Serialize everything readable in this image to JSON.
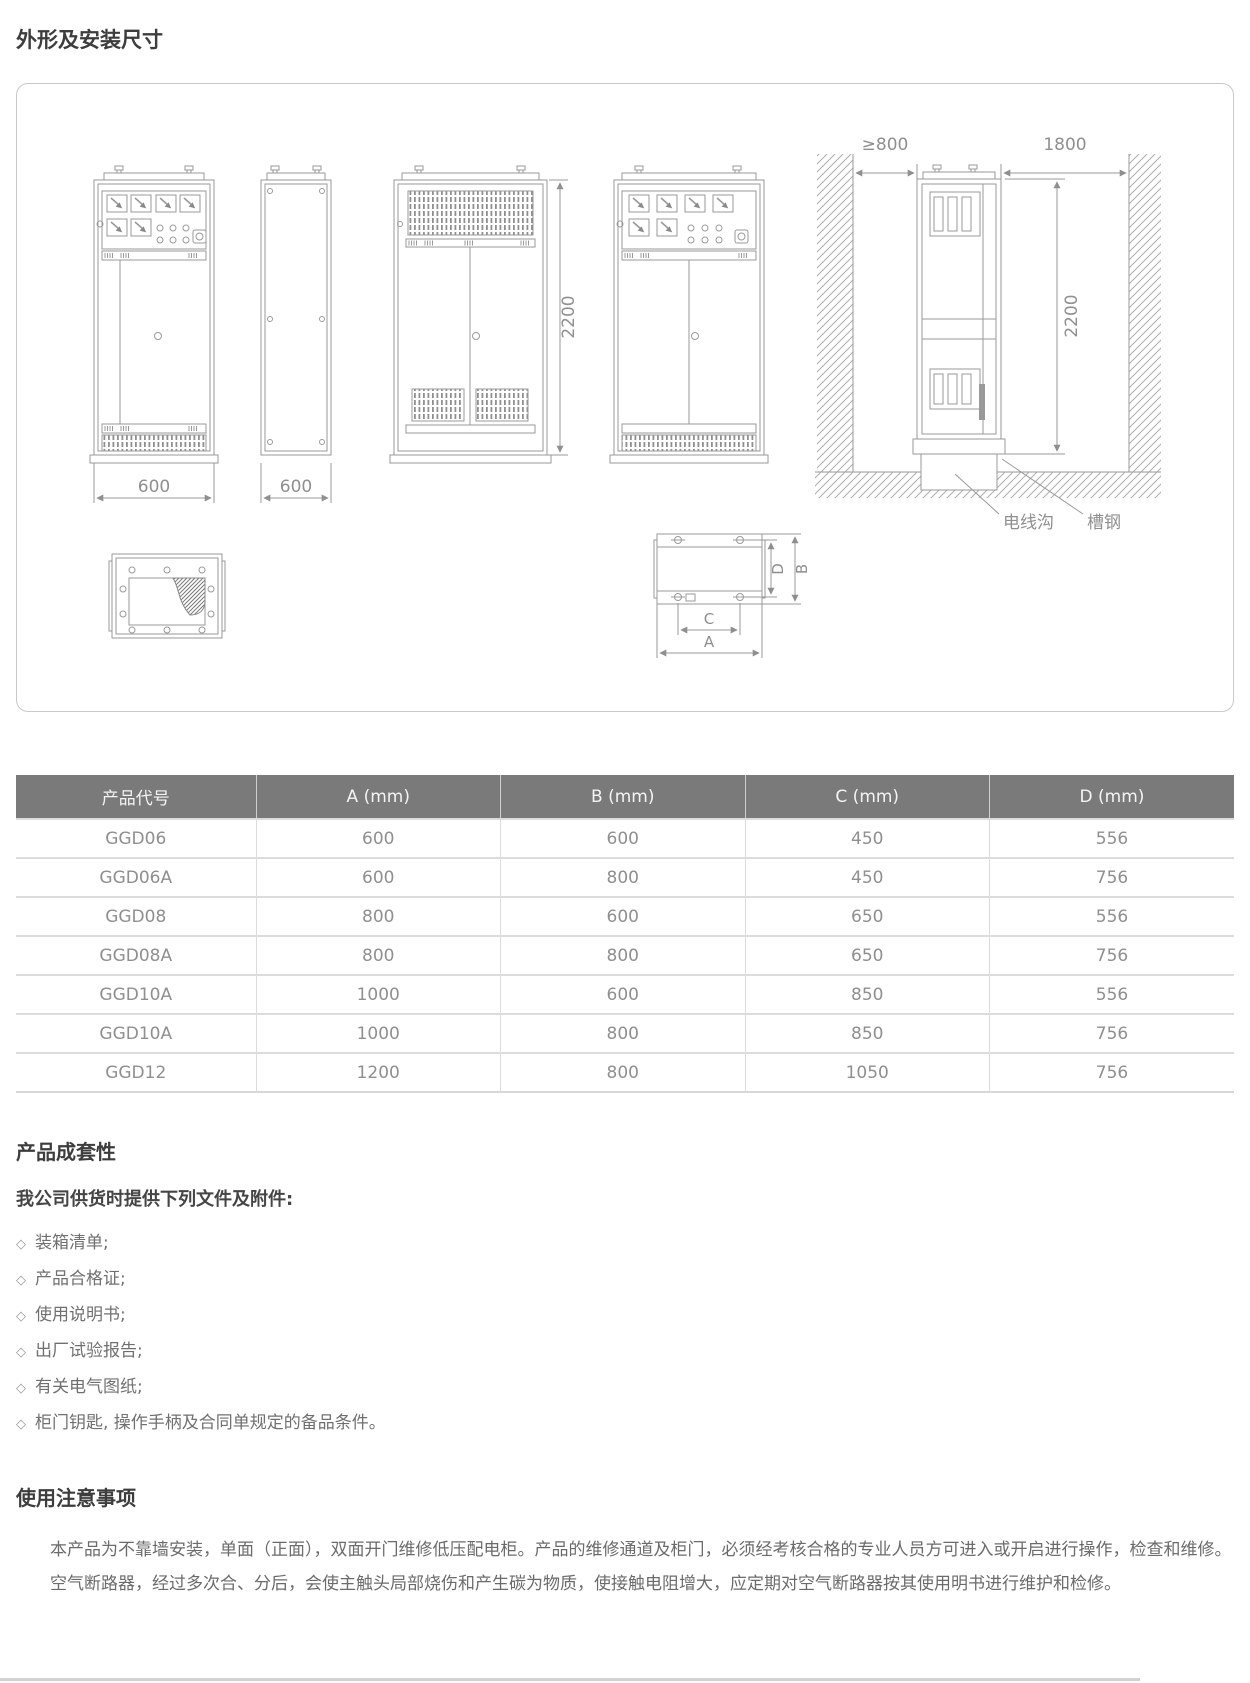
{
  "page": {
    "section1_title": "外形及安装尺寸",
    "section2_title": "产品成套性",
    "section2_subtitle": "我公司供货时提供下列文件及附件:",
    "section3_title": "使用注意事项"
  },
  "diagram": {
    "labels": {
      "front_width": "600",
      "side_depth": "600",
      "cabinet_height": "2200",
      "install_height": "2200",
      "wall_clearance": "≥800",
      "rear_clearance": "1800",
      "cable_trench": "电线沟",
      "channel_steel": "槽钢",
      "dim_a": "A",
      "dim_b": "B",
      "dim_c": "C",
      "dim_d": "D"
    }
  },
  "table": {
    "columns": [
      "产品代号",
      "A (mm)",
      "B (mm)",
      "C (mm)",
      "D (mm)"
    ],
    "rows": [
      [
        "GGD06",
        "600",
        "600",
        "450",
        "556"
      ],
      [
        "GGD06A",
        "600",
        "800",
        "450",
        "756"
      ],
      [
        "GGD08",
        "800",
        "600",
        "650",
        "556"
      ],
      [
        "GGD08A",
        "800",
        "800",
        "650",
        "756"
      ],
      [
        "GGD10A",
        "1000",
        "600",
        "850",
        "556"
      ],
      [
        "GGD10A",
        "1000",
        "800",
        "850",
        "756"
      ],
      [
        "GGD12",
        "1200",
        "800",
        "1050",
        "756"
      ]
    ]
  },
  "checklist": {
    "bullet": "◇",
    "items": [
      "装箱清单;",
      "产品合格证;",
      "使用说明书;",
      "出厂试验报告;",
      "有关电气图纸;",
      "柜门钥匙, 操作手柄及合同单规定的备品条件。"
    ]
  },
  "notes": {
    "paragraphs": [
      "本产品为不靠墙安装，单面（正面），双面开门维修低压配电柜。产品的维修通道及柜门，必须经考核合格的专业人员方可进入或开启进行操作，检查和维修。",
      "空气断路器，经过多次合、分后，会使主触头局部烧伤和产生碳为物质，使接触电阻增大，应定期对空气断路器按其使用明书进行维护和检修。"
    ]
  }
}
